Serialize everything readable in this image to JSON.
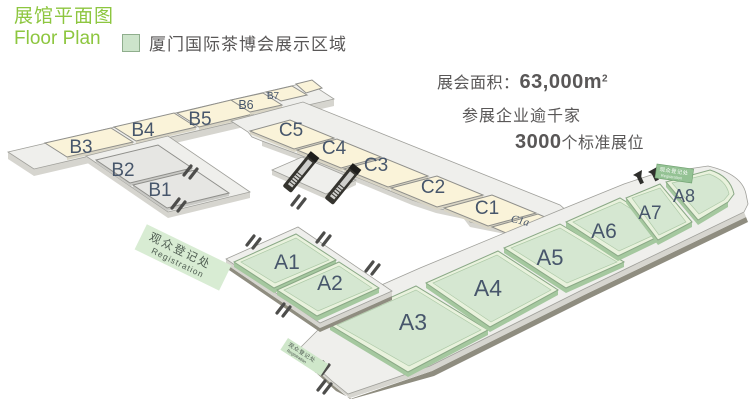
{
  "header": {
    "title_zh": "展馆平面图",
    "title_en": "Floor Plan",
    "legend_text": "厦门国际茶博会展示区域"
  },
  "stats": {
    "area_label": "展会面积：",
    "area_value": "63,000m",
    "area_sup": "2",
    "line2": "参展企业逾千家",
    "line3_num": "3000",
    "line3_text": "个标准展位"
  },
  "floorplan": {
    "halls": [
      {
        "id": "a1",
        "label": "A1"
      },
      {
        "id": "a2",
        "label": "A2"
      },
      {
        "id": "a3",
        "label": "A3"
      },
      {
        "id": "a4",
        "label": "A4"
      },
      {
        "id": "a5",
        "label": "A5"
      },
      {
        "id": "a6",
        "label": "A6"
      },
      {
        "id": "a7",
        "label": "A7"
      },
      {
        "id": "a8",
        "label": "A8"
      },
      {
        "id": "b1",
        "label": "B1"
      },
      {
        "id": "b2",
        "label": "B2"
      },
      {
        "id": "b3",
        "label": "B3"
      },
      {
        "id": "b4",
        "label": "B4"
      },
      {
        "id": "b5",
        "label": "B5"
      },
      {
        "id": "b6",
        "label": "B6"
      },
      {
        "id": "b7",
        "label": "B7"
      },
      {
        "id": "c1",
        "label": "C1"
      },
      {
        "id": "c2",
        "label": "C2"
      },
      {
        "id": "c3",
        "label": "C3"
      },
      {
        "id": "c4",
        "label": "C4"
      },
      {
        "id": "c5",
        "label": "C5"
      }
    ],
    "annex_label": "C1a",
    "registration_left": {
      "zh": "观众登记处",
      "en": "Registration"
    },
    "registration_bottom": {
      "zh": "观众登记处",
      "en": "Registration"
    },
    "registration_a8": {
      "zh": "观众登记处",
      "en": "Registration"
    }
  },
  "colors": {
    "accent_green": "#8dc63f",
    "hall_a_fill": "#d5e7d1",
    "hall_bc_fill": "#faf3d9",
    "text_gray": "#595757",
    "hall_label": "#47566b"
  }
}
